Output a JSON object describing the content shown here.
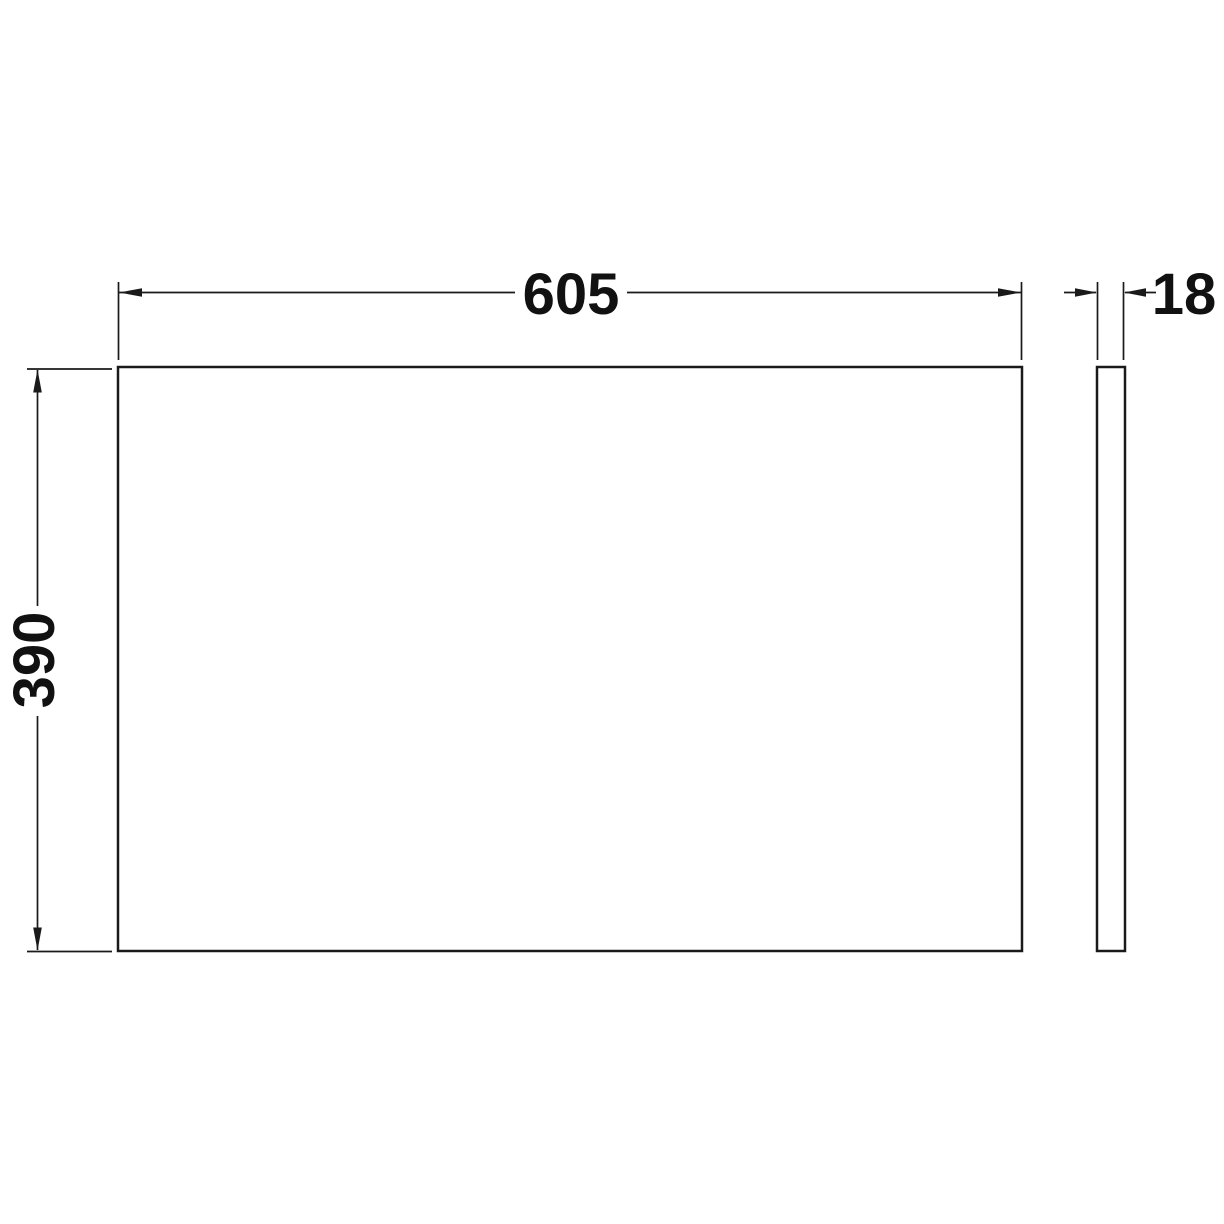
{
  "page": {
    "background_color": "#ffffff"
  },
  "diagram": {
    "type": "technical-dimension-drawing",
    "subject": "rectangular panel, front view and edge view",
    "line_color": "#1a1a1a",
    "text_color": "#111111",
    "panel_fill": "#ffffff",
    "views": {
      "front": {
        "name": "front-view-panel",
        "width_dimension": {
          "value": "605"
        },
        "height_dimension": {
          "value": "390"
        }
      },
      "side": {
        "name": "side-edge-view-panel",
        "thickness_dimension": {
          "value": "18"
        }
      }
    }
  }
}
